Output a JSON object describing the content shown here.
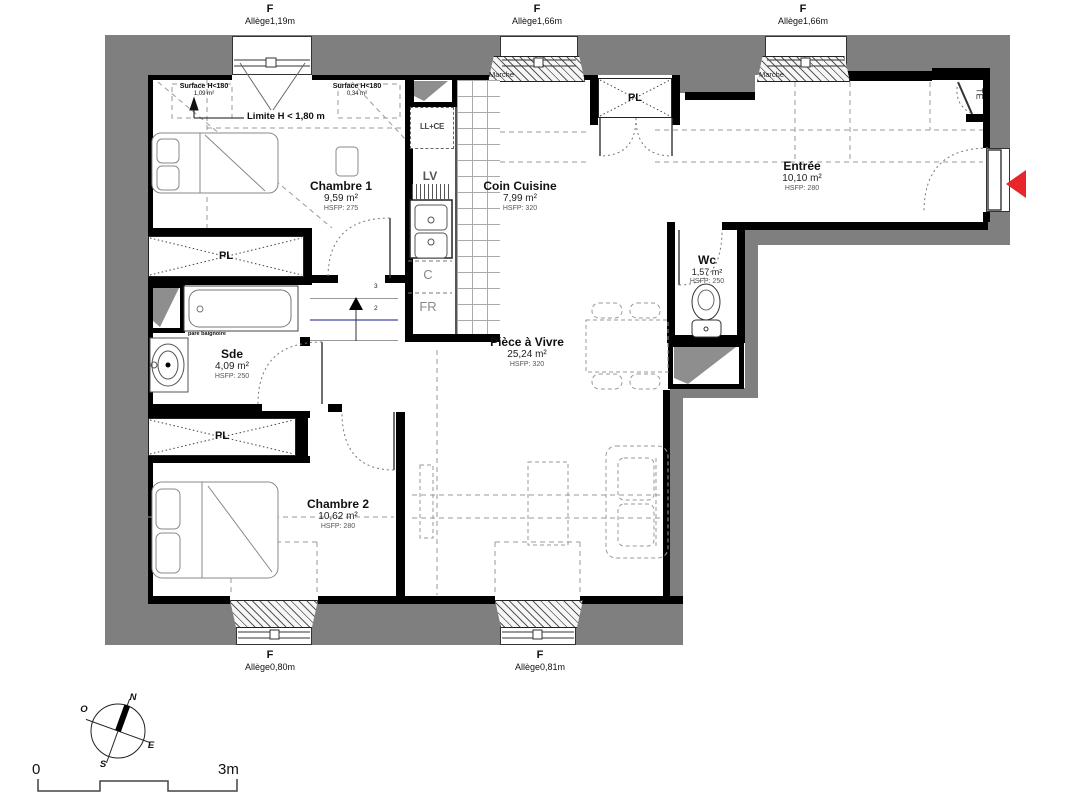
{
  "windows_top": [
    {
      "code": "F",
      "allege": "Allège1,19m"
    },
    {
      "code": "F",
      "allege": "Allège1,66m"
    },
    {
      "code": "F",
      "allege": "Allège1,66m"
    }
  ],
  "windows_bottom": [
    {
      "code": "F",
      "allege": "Allège0,80m"
    },
    {
      "code": "F",
      "allege": "Allège0,81m"
    }
  ],
  "rooms": [
    {
      "name": "Chambre 1",
      "area": "9,59 m²",
      "hsfp": "HSFP: 275"
    },
    {
      "name": "Coin Cuisine",
      "area": "7,99 m²",
      "hsfp": "HSFP: 320"
    },
    {
      "name": "Entrée",
      "area": "10,10 m²",
      "hsfp": "HSFP: 280"
    },
    {
      "name": "Wc",
      "area": "1,57 m²",
      "hsfp": "HSFP: 250"
    },
    {
      "name": "Pièce à Vivre",
      "area": "25,24 m²",
      "hsfp": "HSFP: 320"
    },
    {
      "name": "Sde",
      "area": "4,09 m²",
      "hsfp": "HSFP: 250"
    },
    {
      "name": "Chambre 2",
      "area": "10,62 m²",
      "hsfp": "HSFP: 280"
    }
  ],
  "labels": {
    "pl": "PL",
    "te": "TE",
    "llce": "LL+CE",
    "lv": "LV",
    "c": "C",
    "fr": "FR",
    "marche": "Marche",
    "surface_left_1": "Surface H<180",
    "surface_left_2": "1,09 m²",
    "surface_right_1": "Surface H<180",
    "surface_right_2": "0,34 m²",
    "limite": "Limite H < 1,80 m",
    "pare_baignoire": "pare baignoire",
    "step3": "3",
    "step2": "2"
  },
  "compass": {
    "n": "N",
    "o": "O",
    "e": "E",
    "s": "S"
  },
  "scale": {
    "zero": "0",
    "three": "3m"
  },
  "colors": {
    "exterior_wall": "#7f7f7f",
    "interior_wall": "#000000",
    "entry_arrow": "#e8252a",
    "stair_line_blue": "#8b8bc8"
  }
}
